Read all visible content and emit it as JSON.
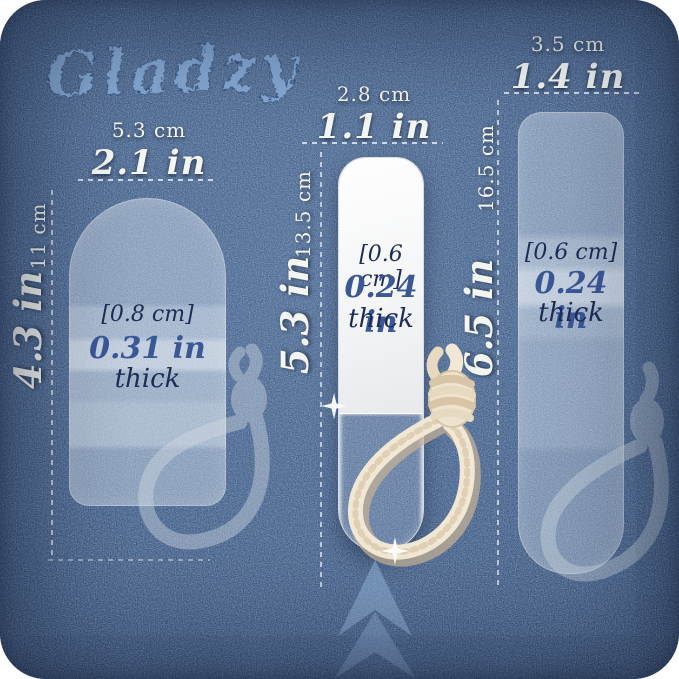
{
  "brand": {
    "name": "Gladzy"
  },
  "files": [
    {
      "size": "small",
      "width_cm": "5.3 cm",
      "width_in": "2.1 in",
      "length_cm": "11 cm",
      "length_in": "4.3 in",
      "thickness_cm": "[0.8 cm]",
      "thickness_in": "0.31 in",
      "thickness_word": "thick"
    },
    {
      "size": "medium",
      "width_cm": "2.8 cm",
      "width_in": "1.1 in",
      "length_cm": "13.5 cm",
      "length_in": "5.3 in",
      "thickness_cm": "[0.6 cm]",
      "thickness_in": "0.24 in",
      "thickness_word": "thick"
    },
    {
      "size": "large",
      "width_cm": "3.5 cm",
      "width_in": "1.4 in",
      "length_cm": "16.5 cm",
      "length_in": "6.5 in",
      "thickness_cm": "[0.6 cm]",
      "thickness_in": "0.24 in",
      "thickness_word": "thick"
    }
  ],
  "icons": {
    "chevron": "double-chevron-up",
    "sparkle": "four-point-sparkle",
    "rope": "hanging-rope-loop"
  },
  "colors": {
    "denim_base": "#33507e",
    "denim_dark": "#1b3156",
    "denim_light": "#466590",
    "label_white": "#f3f5f1",
    "label_navy": "#1d2c55",
    "label_blue": "#3a5796",
    "logo_blue": "#8fb2dd",
    "rope_cream": "#f1e7d4",
    "ghost_rope": "#d3dbe4"
  }
}
